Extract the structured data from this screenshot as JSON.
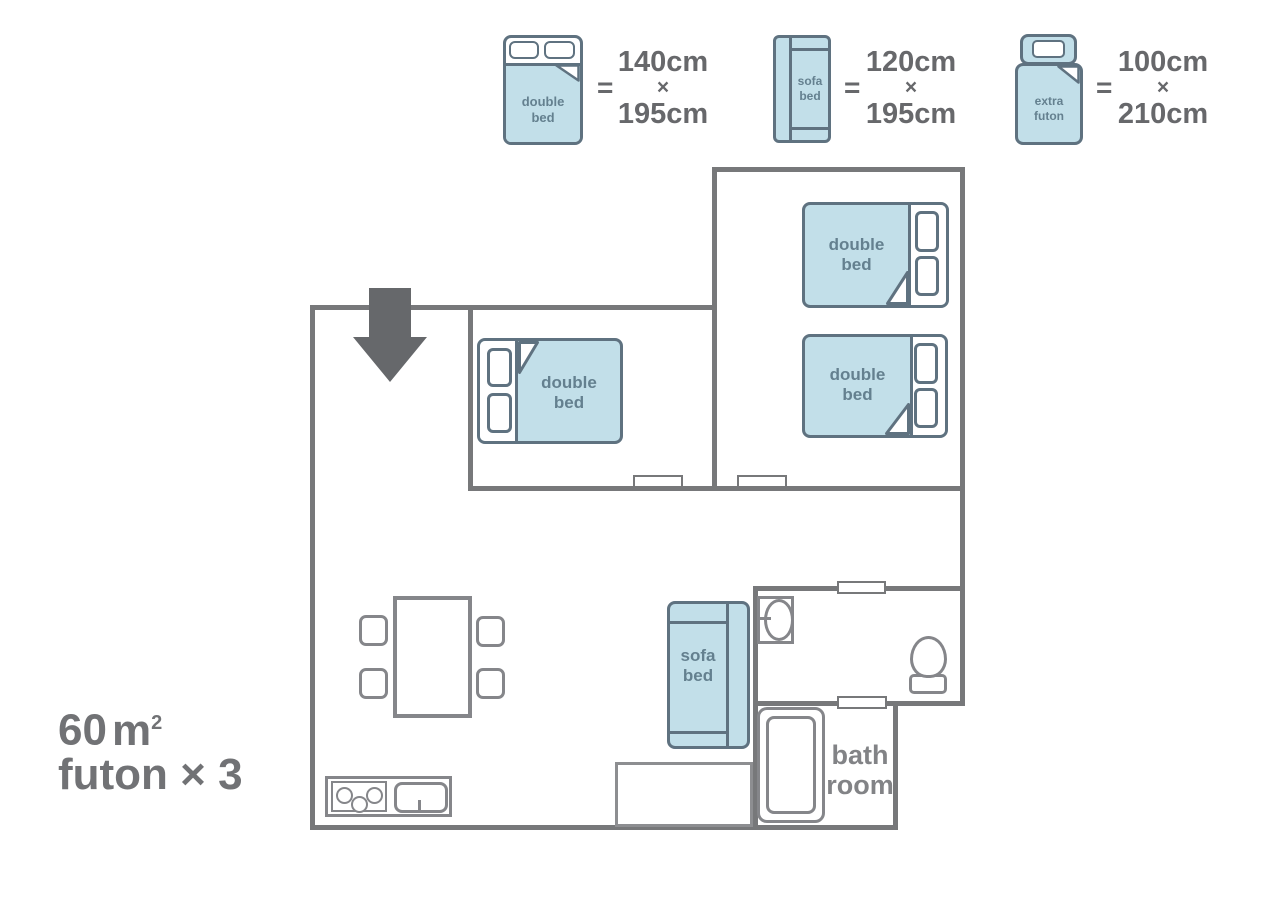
{
  "colors": {
    "wall_gray": "#77787a",
    "furniture_outline_gray": "#85868a",
    "bed_fill_blue": "#c2dfe9",
    "bed_outline": "#5f7280",
    "bed_text": "#64808f",
    "legend_text": "#67686b",
    "info_text": "#717275",
    "arrow_gray": "#66686b"
  },
  "icons": {
    "entrance_arrow": "▼"
  },
  "legend": {
    "double_bed": {
      "label_line1": "double",
      "label_line2": "bed",
      "equals": "=",
      "dim_line1": "140cm",
      "dim_times": "×",
      "dim_line2": "195cm"
    },
    "sofa_bed": {
      "label_line1": "sofa",
      "label_line2": "bed",
      "equals": "=",
      "dim_line1": "120cm",
      "dim_times": "×",
      "dim_line2": "195cm"
    },
    "extra_futon": {
      "label_line1": "extra",
      "label_line2": "futon",
      "equals": "=",
      "dim_line1": "100cm",
      "dim_times": "×",
      "dim_line2": "210cm"
    }
  },
  "plan": {
    "double_bed_label_line1": "double",
    "double_bed_label_line2": "bed",
    "sofa_bed_label_line1": "sofa",
    "sofa_bed_label_line2": "bed",
    "bathroom_label_line1": "bath",
    "bathroom_label_line2": "room"
  },
  "info": {
    "area_number": "60",
    "area_unit": "m",
    "area_superscript": "2",
    "futon_count": "futon × 3"
  }
}
